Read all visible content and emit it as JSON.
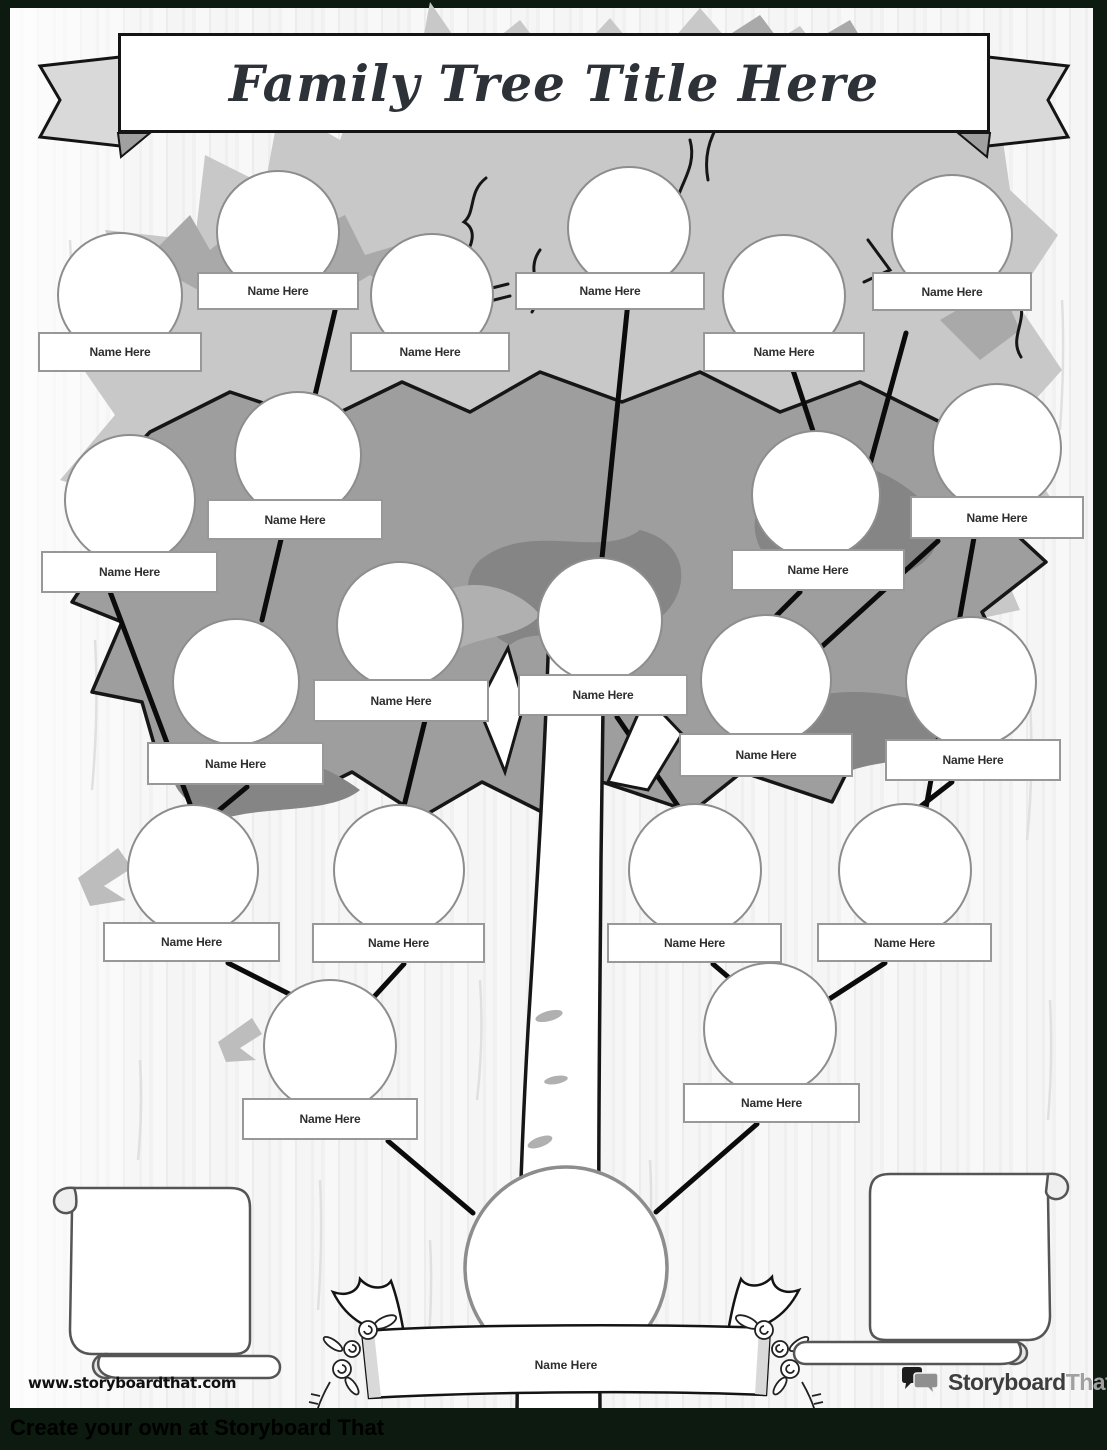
{
  "banner": {
    "title": "Family Tree Title Here"
  },
  "node_label": "Name Here",
  "root": {
    "label": "Name Here"
  },
  "footer": {
    "website": "www.storyboardthat.com",
    "logo_primary": "Storyboard",
    "logo_secondary": "That",
    "bottom_bar_text": "Create your own at Storyboard That"
  },
  "colors": {
    "page_border": "#0c1a0f",
    "canopy_light": "#c8c8c8",
    "canopy_mid": "#9e9e9e",
    "canopy_dark": "#858585",
    "connector_black": "#0b0b0b"
  },
  "icons": {
    "logo_icon": "speech-bubbles-icon"
  }
}
